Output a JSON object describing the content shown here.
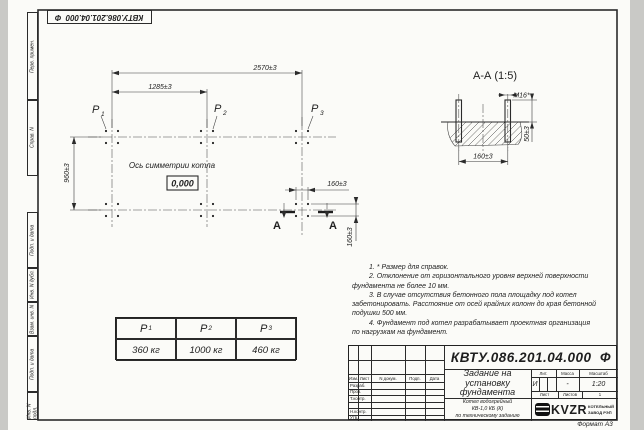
{
  "doc_number": "КВТУ.086.201.04.000  Ф",
  "sheet": {
    "format_label": "Формат А3",
    "margin_labels": {
      "perv_primen": "Перв. примен.",
      "sprav_n": "Справ. N",
      "podp_data_1": "Подп. и дата",
      "inv_n_dubl": "Инв. N дубл.",
      "vzam_inv_n": "Взам. инв. N",
      "podp_data_2": "Подп. и дата",
      "inv_n_podl": "Инв. N подл."
    }
  },
  "plan": {
    "dim_2570": "2570±3",
    "dim_1285": "1285±3",
    "dim_960": "960±3",
    "dim_160_h": "160±3",
    "dim_160_v": "160±3",
    "axis_label": "Ось симметрии котла",
    "elevation": "0,000",
    "p1_base": "P",
    "p1_sub": "1",
    "p2_base": "P",
    "p2_sub": "2",
    "p3_base": "P",
    "p3_sub": "3",
    "section_letter": "А"
  },
  "section": {
    "title": "А-А (1:5)",
    "bolt_label": "М16*",
    "dim_50": "50±3",
    "dim_160": "160±3"
  },
  "notes": {
    "lines": [
      "1. * Размер для справок.",
      "2. Отклонение от горизонтального уровня верхней поверхности",
      "фундамента не более 10 мм.",
      "3. В случае отсутствия бетонного пола площадку под котел",
      "забетонировать. Расстояние от осей крайних колонн до края бетонной",
      "подушки 500 мм.",
      "4. Фундамент под котел разрабатывает проектная организация",
      "по нагрузкам на фундамент."
    ]
  },
  "load_table": {
    "headers": [
      {
        "base": "P",
        "sub": "1"
      },
      {
        "base": "P",
        "sub": "2"
      },
      {
        "base": "P",
        "sub": "3"
      }
    ],
    "values": [
      "360 кг",
      "1000 кг",
      "460 кг"
    ]
  },
  "title_block": {
    "title_line1": "Задание на",
    "title_line2": "установку",
    "title_line3": "фундамента",
    "subtitle_line1": "Котел водогрейный",
    "subtitle_line2": "КВ-1,0 КБ (К)",
    "subtitle_line3": "по техническому заданию",
    "cols": {
      "izm": "Изм.",
      "list": "Лист",
      "n_dokum": "N докум.",
      "podp": "Подп.",
      "data": "Дата"
    },
    "rows": {
      "razrab": "Разраб.",
      "prov": "Пров.",
      "t_kontr": "Т.контр.",
      "n_kontr": "Н.контр.",
      "utv": "Утв."
    },
    "lit_label": "Лит.",
    "massa_label": "Масса",
    "masshtab_label": "Масштаб",
    "lit_value": "И",
    "massa_value": "-",
    "masshtab_value": "1:20",
    "list_label": "Лист",
    "listov_label": "Листов",
    "listov_value": "1",
    "logo_text": "KVZR",
    "company_line1": "КОТЕЛЬНЫЙ",
    "company_line2": "ЗАВОД РЭП"
  },
  "colors": {
    "line": "#2b2b2b",
    "paper": "#fbfbf8",
    "background": "#c9c9c6"
  }
}
